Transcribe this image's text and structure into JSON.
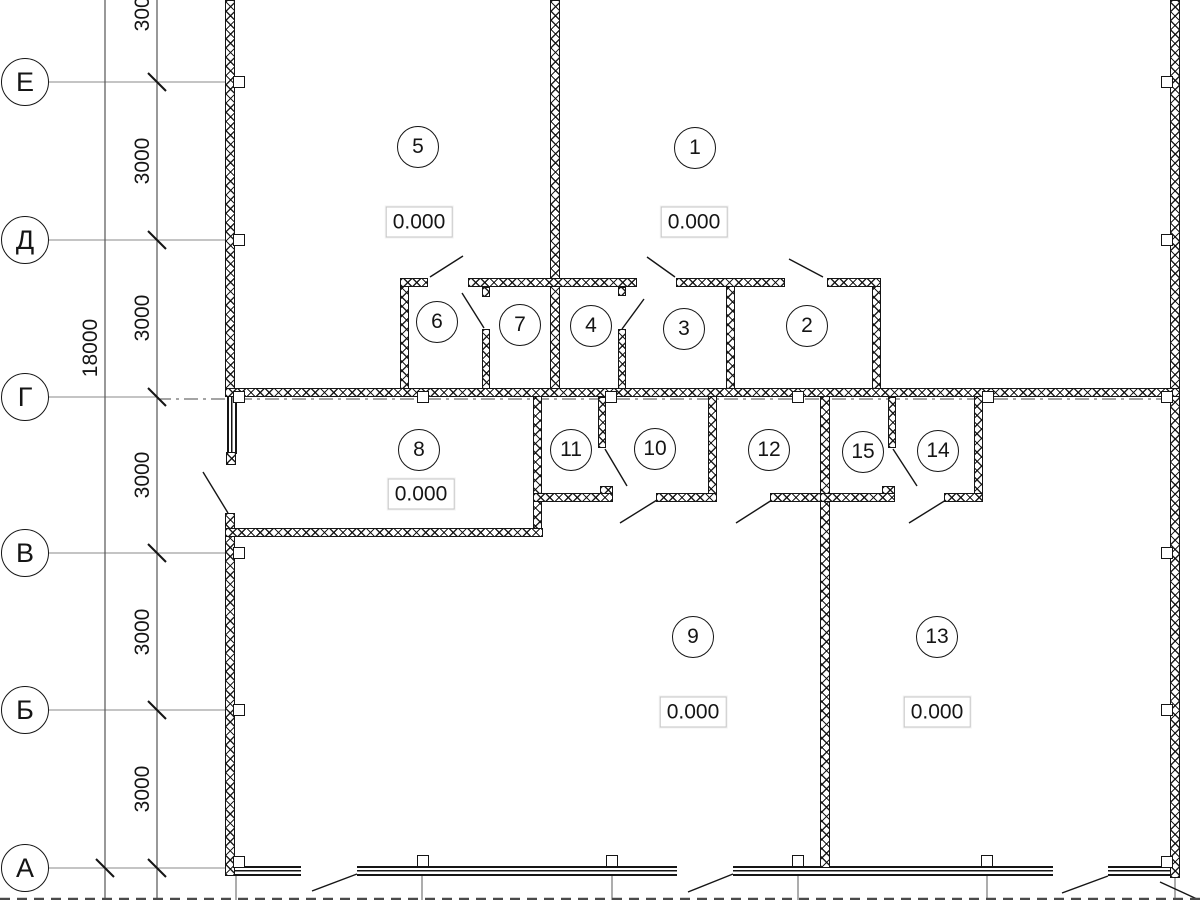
{
  "title": "Floor plan with axis grid and room numbers",
  "colors": {
    "line": "#151515",
    "axis_gray": "#8a8a8a",
    "dim_gray": "#555555",
    "elev_border": "#c6c6c6",
    "background": "#ffffff"
  },
  "axes": {
    "bubbles": [
      {
        "label": "Е",
        "x": 25,
        "y": 82
      },
      {
        "label": "Д",
        "x": 25,
        "y": 240
      },
      {
        "label": "Г",
        "x": 25,
        "y": 397
      },
      {
        "label": "В",
        "x": 25,
        "y": 553
      },
      {
        "label": "Б",
        "x": 25,
        "y": 710
      },
      {
        "label": "А",
        "x": 25,
        "y": 868
      }
    ],
    "dim_labels": [
      {
        "text": "3000",
        "x": 143,
        "y": 8
      },
      {
        "text": "3000",
        "x": 143,
        "y": 161
      },
      {
        "text": "3000",
        "x": 143,
        "y": 318
      },
      {
        "text": "3000",
        "x": 143,
        "y": 475
      },
      {
        "text": "3000",
        "x": 143,
        "y": 632
      },
      {
        "text": "3000",
        "x": 143,
        "y": 789
      },
      {
        "text": "18000",
        "x": 91,
        "y": 348
      }
    ]
  },
  "rooms": [
    {
      "number": "1",
      "x": 695,
      "y": 148
    },
    {
      "number": "2",
      "x": 807,
      "y": 326
    },
    {
      "number": "3",
      "x": 684,
      "y": 329
    },
    {
      "number": "4",
      "x": 591,
      "y": 326
    },
    {
      "number": "5",
      "x": 418,
      "y": 147
    },
    {
      "number": "6",
      "x": 437,
      "y": 322
    },
    {
      "number": "7",
      "x": 520,
      "y": 325
    },
    {
      "number": "8",
      "x": 419,
      "y": 450
    },
    {
      "number": "9",
      "x": 693,
      "y": 637
    },
    {
      "number": "10",
      "x": 655,
      "y": 449
    },
    {
      "number": "11",
      "x": 571,
      "y": 450
    },
    {
      "number": "12",
      "x": 769,
      "y": 450
    },
    {
      "number": "13",
      "x": 937,
      "y": 637
    },
    {
      "number": "14",
      "x": 938,
      "y": 451
    },
    {
      "number": "15",
      "x": 863,
      "y": 452
    }
  ],
  "elevations": [
    {
      "text": "0.000",
      "x": 419,
      "y": 222
    },
    {
      "text": "0.000",
      "x": 694,
      "y": 222
    },
    {
      "text": "0.000",
      "x": 421,
      "y": 494
    },
    {
      "text": "0.000",
      "x": 693,
      "y": 712
    },
    {
      "text": "0.000",
      "x": 937,
      "y": 712
    }
  ],
  "plan": {
    "walls": [
      [
        225,
        0,
        10,
        390
      ],
      [
        225,
        513,
        10,
        363
      ],
      [
        226,
        452,
        10,
        13
      ],
      [
        550,
        0,
        10,
        390
      ],
      [
        1170,
        0,
        10,
        878
      ],
      [
        820,
        388,
        10,
        480
      ],
      [
        400,
        278,
        9,
        112
      ],
      [
        482,
        329,
        8,
        61
      ],
      [
        482,
        287,
        8,
        10
      ],
      [
        618,
        329,
        8,
        61
      ],
      [
        618,
        287,
        8,
        9
      ],
      [
        726,
        278,
        9,
        112
      ],
      [
        872,
        278,
        9,
        112
      ],
      [
        533,
        388,
        9,
        148
      ],
      [
        598,
        397,
        8,
        51
      ],
      [
        708,
        388,
        9,
        110
      ],
      [
        888,
        397,
        8,
        51
      ],
      [
        974,
        388,
        9,
        110
      ],
      [
        400,
        278,
        28,
        9
      ],
      [
        468,
        278,
        169,
        9
      ],
      [
        676,
        278,
        109,
        9
      ],
      [
        827,
        278,
        54,
        9
      ],
      [
        225,
        388,
        955,
        9
      ],
      [
        225,
        528,
        318,
        9
      ],
      [
        533,
        493,
        80,
        9
      ],
      [
        600,
        486,
        13,
        8
      ],
      [
        656,
        493,
        61,
        9
      ],
      [
        770,
        493,
        58,
        9
      ],
      [
        820,
        493,
        75,
        9
      ],
      [
        882,
        486,
        13,
        8
      ],
      [
        944,
        493,
        39,
        9
      ]
    ],
    "windows": [
      {
        "x": 227,
        "y": 397,
        "w": 10,
        "h": 57,
        "dir": "v"
      },
      {
        "x": 235,
        "y": 866,
        "w": 66,
        "h": 10,
        "dir": "h"
      },
      {
        "x": 357,
        "y": 866,
        "w": 320,
        "h": 10,
        "dir": "h"
      },
      {
        "x": 733,
        "y": 866,
        "w": 320,
        "h": 10,
        "dir": "h"
      },
      {
        "x": 1108,
        "y": 866,
        "w": 64,
        "h": 10,
        "dir": "h"
      }
    ],
    "markers": [
      [
        233,
        76
      ],
      [
        233,
        234
      ],
      [
        233,
        391
      ],
      [
        233,
        547
      ],
      [
        233,
        704
      ],
      [
        233,
        856
      ],
      [
        1161,
        76
      ],
      [
        1161,
        234
      ],
      [
        1161,
        391
      ],
      [
        1161,
        547
      ],
      [
        1161,
        704
      ],
      [
        1161,
        856
      ],
      [
        417,
        391
      ],
      [
        605,
        391
      ],
      [
        792,
        391
      ],
      [
        982,
        391
      ],
      [
        417,
        855
      ],
      [
        606,
        855
      ],
      [
        792,
        855
      ],
      [
        981,
        855
      ]
    ],
    "axis_lines": [
      [
        48,
        82,
        225,
        82
      ],
      [
        48,
        240,
        225,
        240
      ],
      [
        48,
        397,
        157,
        397
      ],
      [
        48,
        553,
        225,
        553
      ],
      [
        48,
        710,
        225,
        710
      ],
      [
        48,
        868,
        225,
        868
      ]
    ],
    "axis_dashdot": [
      [
        157,
        399,
        1180,
        399
      ]
    ],
    "dim_lines": [
      [
        105,
        0,
        105,
        900
      ],
      [
        157,
        0,
        157,
        900
      ]
    ],
    "grid_lines": [
      [
        236,
        876,
        236,
        900
      ],
      [
        422,
        876,
        422,
        900
      ],
      [
        612,
        876,
        612,
        900
      ],
      [
        798,
        876,
        798,
        900
      ],
      [
        987,
        876,
        987,
        900
      ],
      [
        1175,
        878,
        1175,
        900
      ]
    ],
    "ticks": [
      [
        157,
        82
      ],
      [
        157,
        240
      ],
      [
        157,
        397
      ],
      [
        157,
        553
      ],
      [
        157,
        710
      ],
      [
        157,
        868
      ],
      [
        105,
        868
      ]
    ],
    "door_swings": [
      [
        430,
        277,
        463,
        256
      ],
      [
        462,
        293,
        484,
        328
      ],
      [
        647,
        257,
        675,
        277
      ],
      [
        789,
        259,
        823,
        277
      ],
      [
        622,
        329,
        644,
        299
      ],
      [
        203,
        472,
        228,
        513
      ],
      [
        605,
        449,
        627,
        486
      ],
      [
        620,
        523,
        657,
        500
      ],
      [
        736,
        523,
        772,
        500
      ],
      [
        893,
        449,
        917,
        486
      ],
      [
        909,
        523,
        946,
        500
      ],
      [
        312,
        891,
        357,
        874
      ],
      [
        688,
        892,
        733,
        874
      ],
      [
        1062,
        893,
        1108,
        876
      ],
      [
        1160,
        882,
        1197,
        899
      ]
    ],
    "edge_dashed": [
      [
        0,
        899,
        1200,
        899
      ]
    ]
  }
}
